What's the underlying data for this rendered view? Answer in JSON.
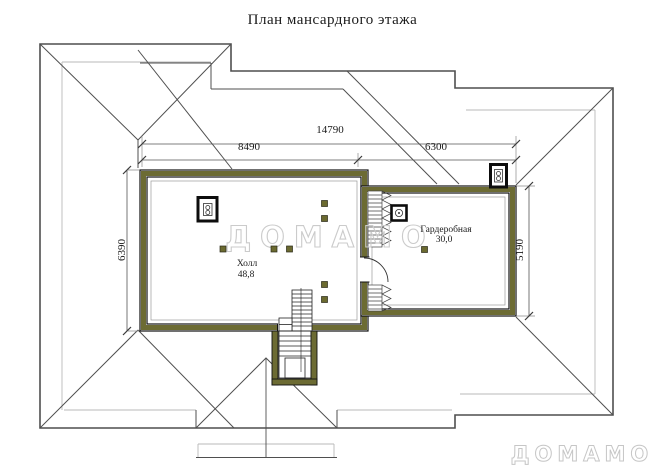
{
  "title": "План мансардного этажа",
  "dimensions": {
    "overall_width": "14790",
    "hall_width": "8490",
    "wardrobe_width": "6300",
    "hall_depth": "6390",
    "wardrobe_depth": "5190"
  },
  "rooms": {
    "hall": {
      "name": "Холл",
      "area": "48,8"
    },
    "wardrobe": {
      "name": "Гардеробная",
      "area": "30,0"
    }
  },
  "watermark": {
    "center": "ДОМАМО",
    "corner": "ДОМАМО"
  },
  "icons": {
    "hall_flue": "chimney-vent-icon",
    "wardrobe_flue": "chimney-vent-icon",
    "roof_flue": "chimney-vent-icon"
  },
  "colors": {
    "wall_fill": "#6c6b33",
    "wall_edge": "#111111",
    "roof_line": "#4f4f4f",
    "light_line": "#b3b3b3",
    "dimension_line": "#555555",
    "text": "#1a1a1a",
    "watermark_outline": "#c9c9c9",
    "post_square": "#6b6a30"
  }
}
